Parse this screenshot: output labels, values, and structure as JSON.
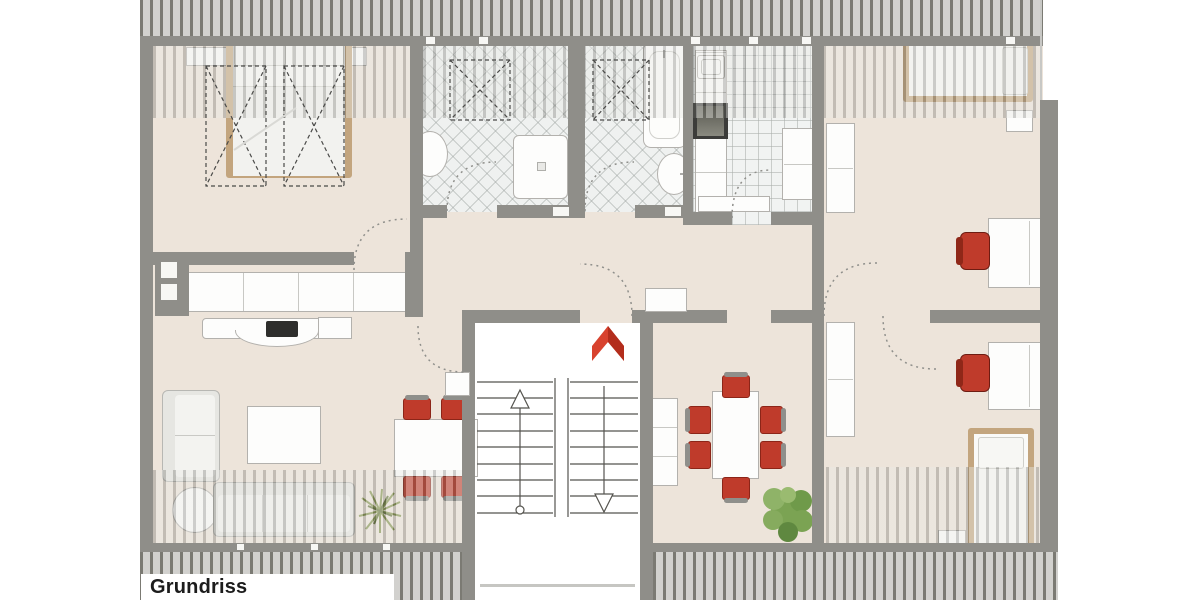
{
  "label": {
    "text": "Grundriss Dachgeschoss"
  },
  "colors": {
    "wall": "#8F8E89",
    "floor": "#EDE4DA",
    "tile": "#EFF1F0",
    "roof_base": "#D2D1CE",
    "roof_stripe": "#7B7A73",
    "accent": "#BF3B2B",
    "accent_dark": "#8C2518",
    "north_red": "#D8422E",
    "north_red_dark": "#B32D1C",
    "bed_frame": "#C3A57E",
    "box_border": "#B3B1AD",
    "box_fill": "#FDFDFC",
    "sofa_fill": "#F1F1EE",
    "sofa_edge": "#B7B7B3",
    "stove": "#3C3C3A",
    "plant": "#7BA353",
    "plant_dark": "#5F8840",
    "grass": "#7D8D45",
    "line_art": "#4A4A48",
    "door_arc": "#8F8F8B",
    "label_text": "#1C1C1C"
  },
  "icons": {
    "north_arrow": "chevron-up",
    "stair_up": "arrow-up-open-triangle",
    "stair_down": "arrow-down-open-triangle",
    "door_swing": "dotted-quarter-arc",
    "skylight": "dashed-rect-with-x"
  }
}
